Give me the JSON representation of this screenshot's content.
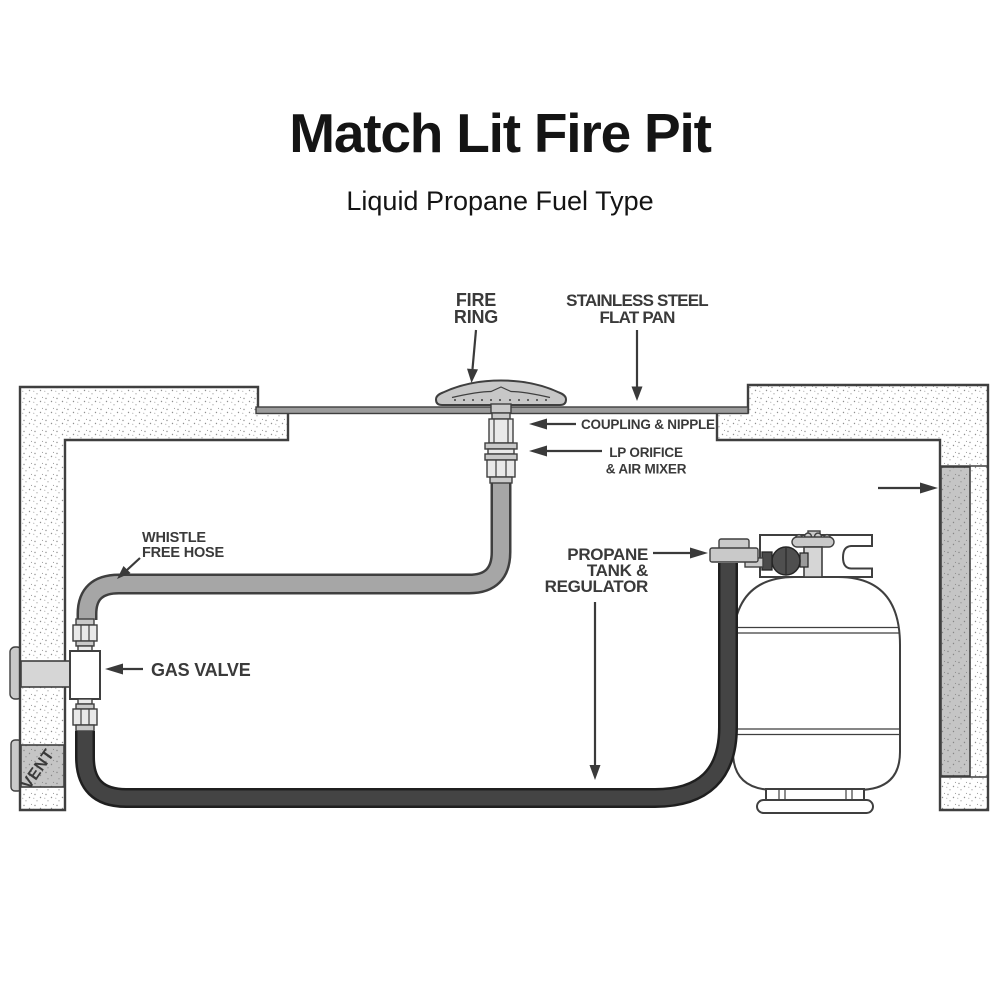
{
  "title": "Match Lit Fire Pit",
  "subtitle": "Liquid Propane Fuel Type",
  "callouts": {
    "fire_ring_1": "FIRE",
    "fire_ring_2": "RING",
    "flat_pan_1": "STAINLESS STEEL",
    "flat_pan_2": "FLAT PAN",
    "coupling": "COUPLING & NIPPLE",
    "orifice_1": "LP ORIFICE",
    "orifice_2": "& AIR MIXER",
    "hose_1": "WHISTLE",
    "hose_2": "FREE HOSE",
    "gas_valve": "GAS VALVE",
    "tank_1": "PROPANE",
    "tank_2": "TANK &",
    "tank_3": "REGULATOR",
    "vent": "VENT"
  },
  "colors": {
    "title": "#141414",
    "label": "#3a3a3a",
    "ink": "#3f3f3f",
    "pan": "#9c9c9c",
    "hose": "#a6a6a6",
    "dark-hose": "#444444",
    "dark-hose-edge": "#1f1f1f",
    "ring": "#c7c7c7",
    "fitting-light": "#e9e9e9",
    "fitting-mid": "#c9c9c9",
    "steel": "#d6d6d6",
    "vent-bg": "#c5c5c5",
    "stip-dot": "#8f8f8f",
    "regulator": "#4f4f4f"
  }
}
